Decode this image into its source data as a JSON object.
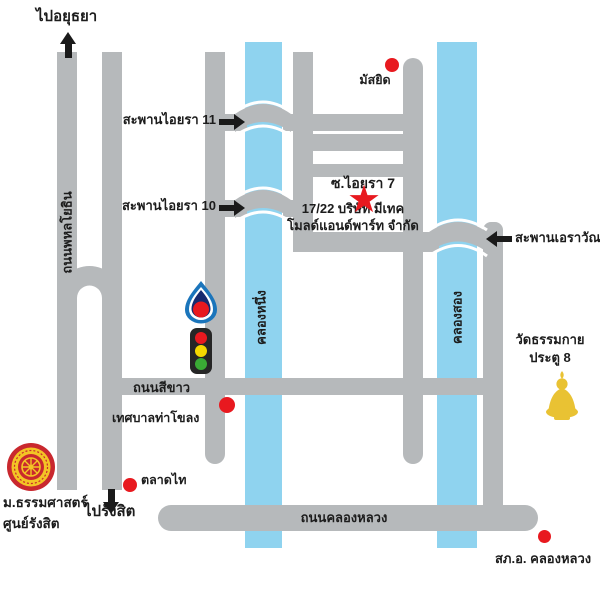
{
  "map": {
    "labels": {
      "to_ayutthaya": "ไปอยุธยา",
      "to_rangsit": "ไปรังสิต",
      "phahonyothin_road": "ถนนพหลโยธิน",
      "canal_one": "คลองหนึ่ง",
      "canal_two": "คลองสอง",
      "bridge_aiyara_11": "สะพานไอยรา 11",
      "bridge_aiyara_10": "สะพานไอยรา 10",
      "bridge_erawan_5": "สะพานเอราวัณ 5",
      "soi_aiyara_7": "ซ.ไอยรา 7",
      "company_line1": "17/22 บริษัท มีเทค",
      "company_line2": "โมลด์แอนด์พาร์ท จำกัด",
      "mosque": "มัสยิด",
      "wat_dhammakaya_line1": "วัดธรรมกาย",
      "wat_dhammakaya_line2": "ประตู 8",
      "sikhao_road": "ถนนสีขาว",
      "thakhlong_municipality": "เทศบาลท่าโขลง",
      "talad_thai_market": "ตลาดไท",
      "thammasat_line1": "ม.ธรรมศาสตร์",
      "thammasat_line2": "ศูนย์รังสิต",
      "khlong_luang_road": "ถนนคลองหลวง",
      "police_station": "สภ.อ. คลองหลวง"
    },
    "star_glyph": "★",
    "colors": {
      "road": "#b6b9bb",
      "canal": "#8fd3ef",
      "marker_red": "#e8191f",
      "star_red": "#e8191f",
      "buddha_gold": "#e9c233",
      "seal_red": "#c9282e",
      "seal_yellow": "#f3c425",
      "ptt_blue": "#1b75bb",
      "ptt_navy": "#172a6e",
      "traffic_yellow": "#f5d800",
      "traffic_green": "#3aaa35",
      "arrow_black": "#1a1a1a"
    }
  }
}
